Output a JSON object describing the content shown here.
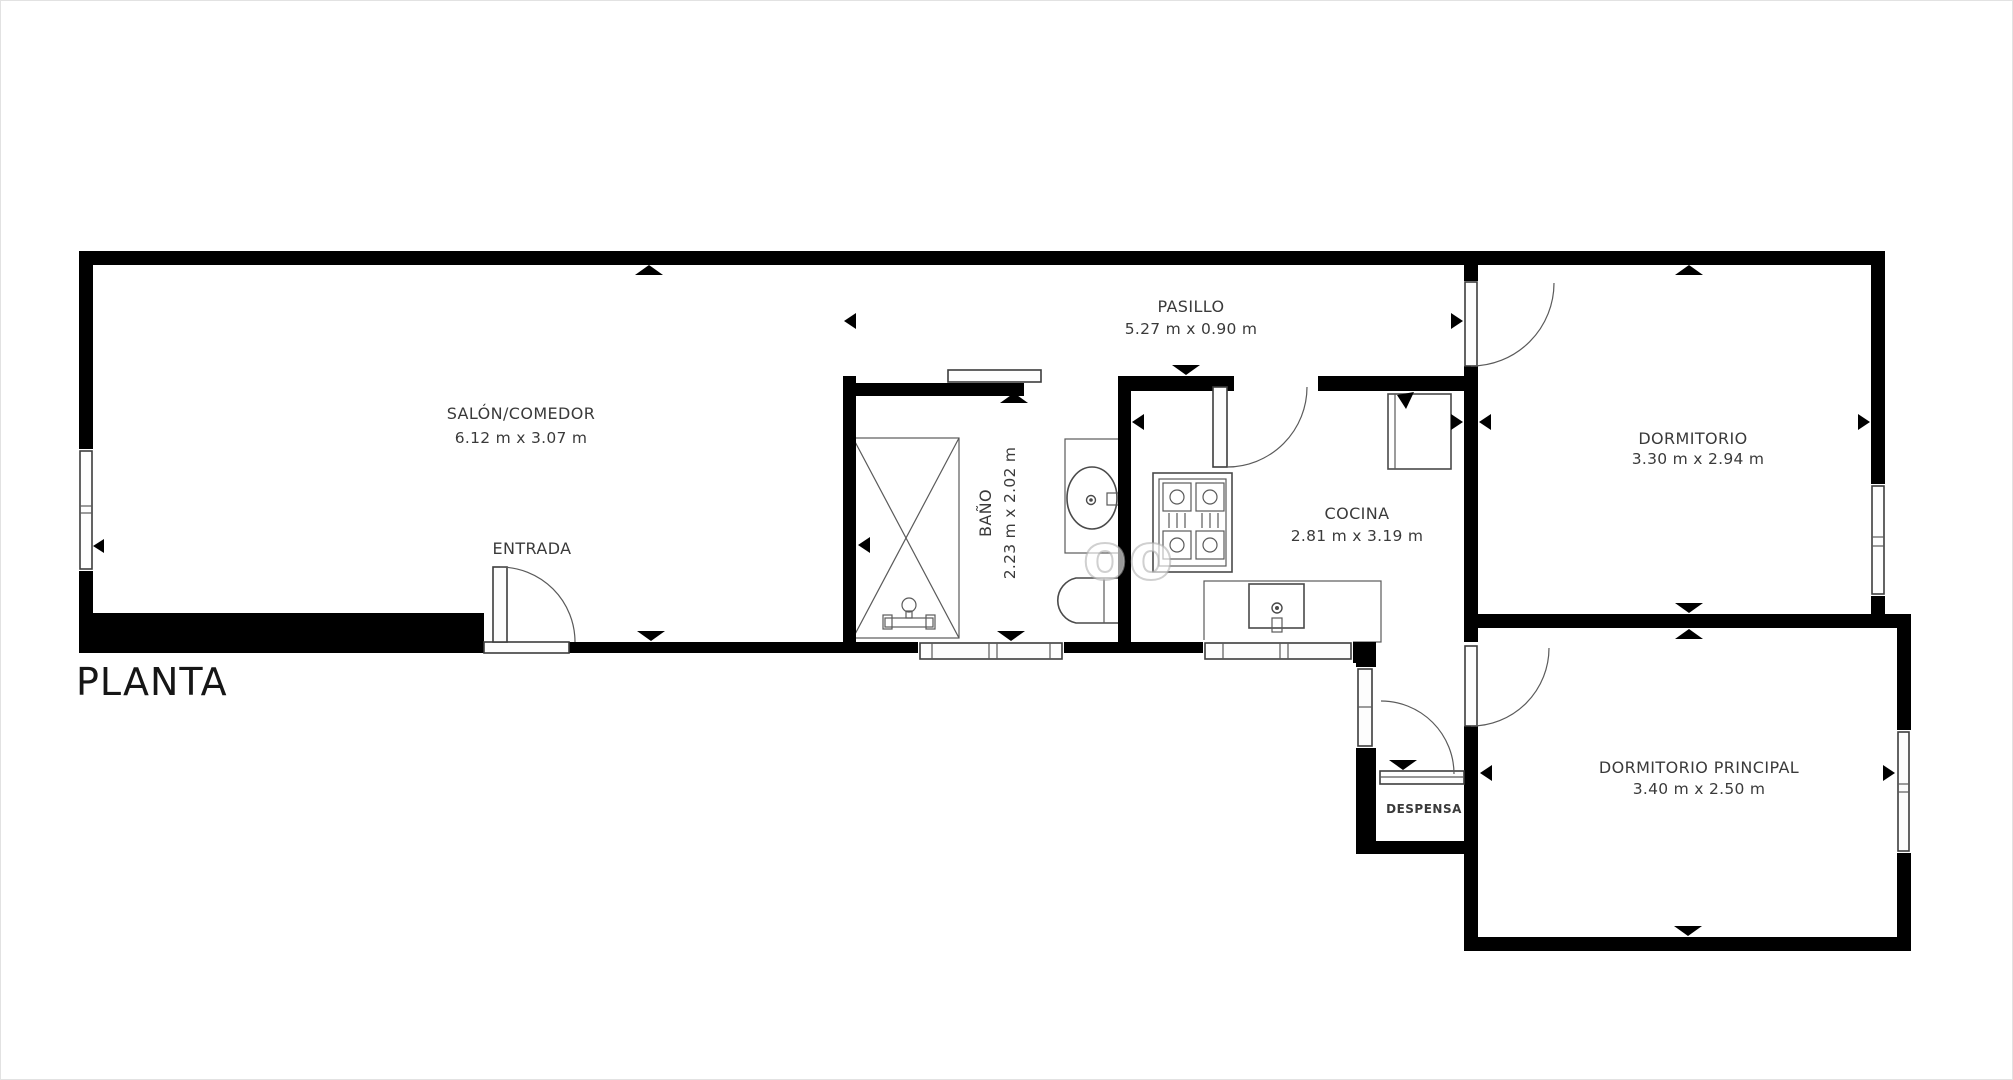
{
  "page": {
    "title": "PLANTA"
  },
  "watermark": {
    "text": "oo"
  },
  "rooms": {
    "salon": {
      "name": "SALÓN/COMEDOR",
      "dims": "6.12 m x 3.07 m"
    },
    "entrada": {
      "name": "ENTRADA"
    },
    "pasillo": {
      "name": "PASILLO",
      "dims": "5.27 m x 0.90 m"
    },
    "bano": {
      "name": "BAÑO",
      "dims": "2.23 m x 2.02 m"
    },
    "cocina": {
      "name": "COCINA",
      "dims": "2.81 m x 3.19 m"
    },
    "dormitorio": {
      "name": "DORMITORIO",
      "dims": "3.30 m x 2.94 m"
    },
    "dormitorio_principal": {
      "name": "DORMITORIO PRINCIPAL",
      "dims": "3.40 m x 2.50 m"
    },
    "despensa": {
      "name": "DESPENSA"
    }
  },
  "colors": {
    "wall": "#000000",
    "fixture_line": "#4a4a4a",
    "label": "#3a3a3a",
    "background": "#ffffff",
    "watermark": "#c8c8c8"
  }
}
